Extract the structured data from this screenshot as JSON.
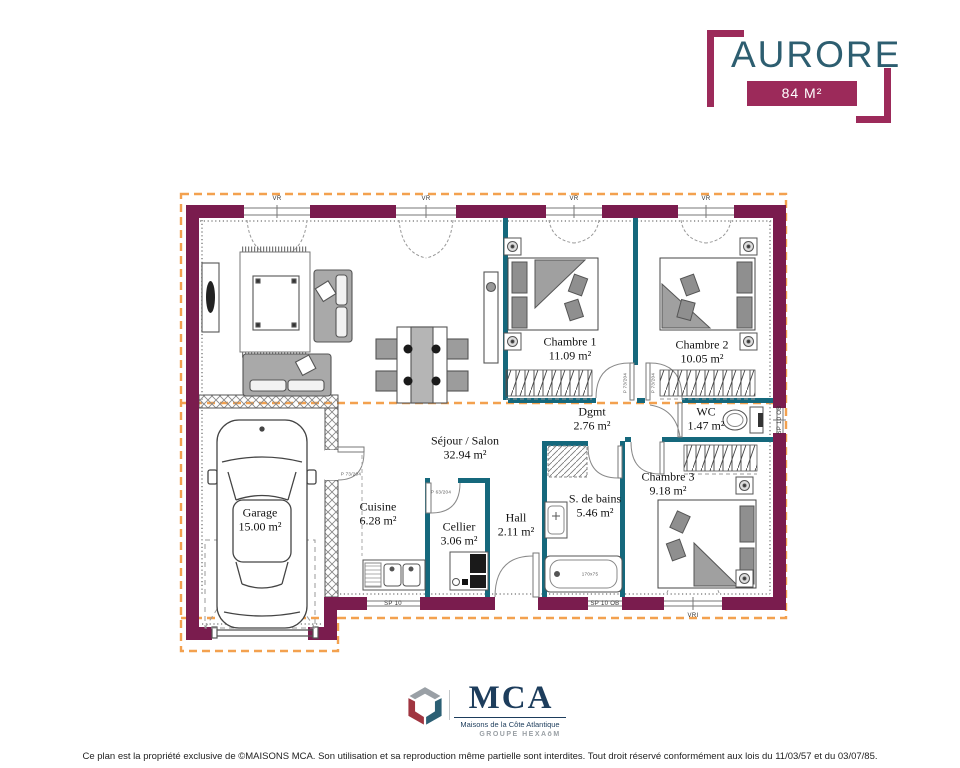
{
  "header": {
    "title": "AURORE",
    "area_badge": "84 M²"
  },
  "plan": {
    "rooms": [
      {
        "name": "Séjour / Salon",
        "area": "32.94 m²"
      },
      {
        "name": "Cuisine",
        "area": "6.28 m²"
      },
      {
        "name": "Cellier",
        "area": "3.06 m²"
      },
      {
        "name": "Hall",
        "area": "2.11 m²"
      },
      {
        "name": "Garage",
        "area": "15.00 m²"
      },
      {
        "name": "S. de bains",
        "area": "5.46 m²"
      },
      {
        "name": "Chambre 3",
        "area": "9.18 m²"
      },
      {
        "name": "Dgmt",
        "area": "2.76 m²"
      },
      {
        "name": "WC",
        "area": "1.47 m²"
      },
      {
        "name": "Chambre 1",
        "area": "11.09 m²"
      },
      {
        "name": "Chambre 2",
        "area": "10.05 m²"
      }
    ],
    "labels": {
      "vr": "VR",
      "vri": "VRI",
      "sp10": "SP 10",
      "sp10ob": "SP 10 OB",
      "p73": "P 73/204",
      "p63": "P 63/204",
      "tub": "170x75"
    }
  },
  "footer": {
    "logo_text": "MCA",
    "logo_subtitle": "Maisons de la Côte Atlantique",
    "logo_group": "GROUPE HEXAōM",
    "disclaimer": "Ce plan est la propriété exclusive de ©MAISONS MCA. Son utilisation et sa reproduction même partielle sont interdites. Tout droit réservé conformément aux lois du 11/03/57 et du 03/07/85."
  },
  "colors": {
    "wall_exterior": "#7a1c4e",
    "wall_interior": "#15687c",
    "roof_dashed": "#f3a14f",
    "accent_magenta": "#9c2a5a",
    "title_teal": "#2d5e70",
    "logo_navy": "#1d3d5c",
    "logo_red": "#a03540"
  }
}
